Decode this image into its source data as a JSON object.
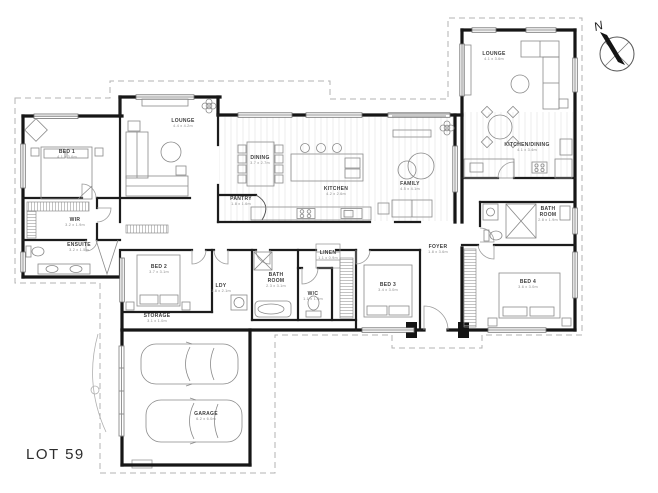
{
  "title": "LOT 59",
  "compass": {
    "label": "N"
  },
  "rooms": {
    "bed1": {
      "label": "BED 1",
      "dims": "4.1 x 3.6m"
    },
    "wir": {
      "label": "WIR",
      "dims": "3.2 x 1.9m"
    },
    "ensuite": {
      "label": "ENSUITE",
      "dims": "3.2 x 1.5m"
    },
    "lounge": {
      "label": "LOUNGE",
      "dims": "4.4 x 4.2m"
    },
    "dining": {
      "label": "DINING",
      "dims": "3.7 x 2.7m"
    },
    "kitchen": {
      "label": "KITCHEN",
      "dims": "4.2 x 2.6m"
    },
    "pantry": {
      "label": "PANTRY",
      "dims": "1.8 x 1.6m"
    },
    "family": {
      "label": "FAMILY",
      "dims": "4.5 x 4.1m"
    },
    "bed2": {
      "label": "BED 2",
      "dims": "3.7 x 3.1m"
    },
    "storage": {
      "label": "STORAGE",
      "dims": "3.1 x 1.0m"
    },
    "ldy": {
      "label": "LDY",
      "dims": "1.8 x 2.1m"
    },
    "bath": {
      "label": "BATH ROOM",
      "dims": "2.3 x 3.1m"
    },
    "wc": {
      "label": "W/C",
      "dims": "1.1 x 1.6m"
    },
    "linen": {
      "label": "LINEN",
      "dims": "1.1 x 0.9m"
    },
    "bed3": {
      "label": "BED 3",
      "dims": "3.4 x 3.0m"
    },
    "foyer": {
      "label": "FOYER",
      "dims": "1.8 x 3.6m"
    },
    "bed4": {
      "label": "BED 4",
      "dims": "3.6 x 3.0m"
    },
    "bath2": {
      "label": "BATH ROOM",
      "dims": "2.8 x 1.9m"
    },
    "lounge2": {
      "label": "LOUNGE",
      "dims": "4.1 x 3.6m"
    },
    "kitchen_dining": {
      "label": "KITCHEN/DINING",
      "dims": "4.1 x 3.4m"
    },
    "garage": {
      "label": "GARAGE",
      "dims": "6.2 x 6.0m"
    }
  }
}
